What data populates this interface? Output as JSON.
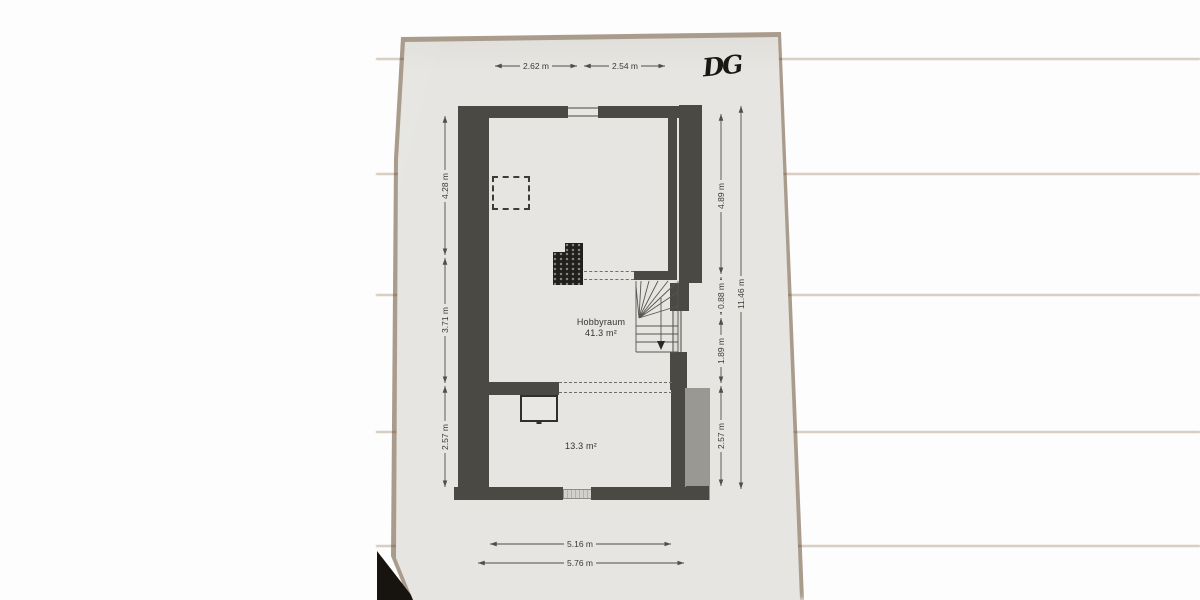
{
  "plan": {
    "floor_label": "DG",
    "rooms": [
      {
        "name": "Hobbyraum",
        "area": "41.3 m²"
      },
      {
        "name": "",
        "area": "13.3 m²"
      }
    ],
    "dimensions": {
      "top": [
        "2.62 m",
        "2.54 m"
      ],
      "left": [
        "4.28 m",
        "3.71 m",
        "2.57 m"
      ],
      "right": [
        "4.89 m",
        "0.88 m",
        "1.89 m",
        "2.57 m"
      ],
      "right_total": "11.46 m",
      "bottom": [
        "5.16 m",
        "5.76 m"
      ]
    },
    "colors": {
      "wall": "#4a4943",
      "chimney": "#21201c",
      "paper": "#e6e5e1",
      "wood": "#c2945c",
      "dimension_line": "#4f4e49"
    }
  }
}
